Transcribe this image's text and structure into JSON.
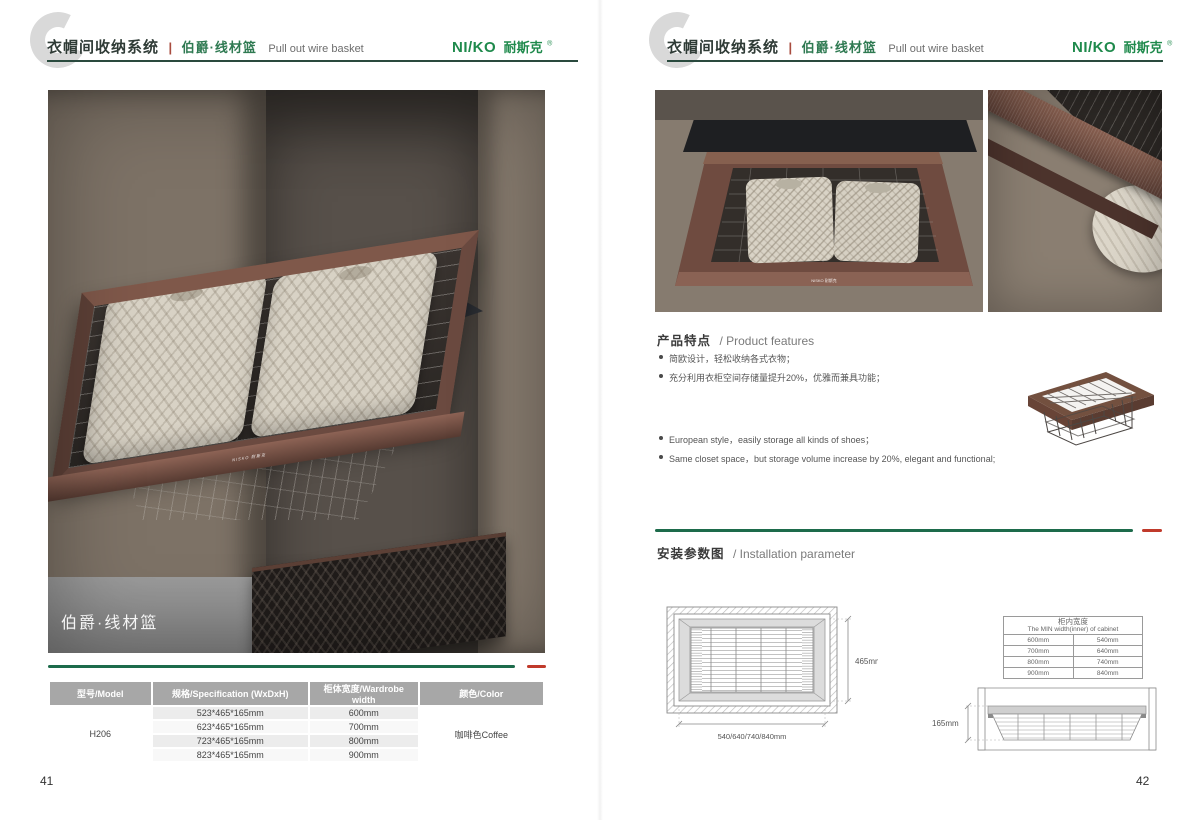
{
  "brand": {
    "logo_latin": "NI/KO",
    "logo_cjk": "耐斯克",
    "logo_reg": "®",
    "logo_full": "NISKO 耐斯克"
  },
  "header": {
    "title_zh": "衣帽间收纳系统",
    "divider": "|",
    "subtitle_zh": "伯爵·线材篮",
    "subtitle_en": "Pull out wire basket"
  },
  "page_left": {
    "photo_label": "伯爵·线材篮",
    "table": {
      "headers": [
        "型号/Model",
        "规格/Specification (WxDxH)",
        "柜体宽度/Wardrobe width",
        "颜色/Color"
      ],
      "model": "H206",
      "rows": [
        {
          "spec": "523*465*165mm",
          "width": "600mm"
        },
        {
          "spec": "623*465*165mm",
          "width": "700mm"
        },
        {
          "spec": "723*465*165mm",
          "width": "800mm"
        },
        {
          "spec": "823*465*165mm",
          "width": "900mm"
        }
      ],
      "color": "咖啡色Coffee"
    },
    "page_number": "41"
  },
  "page_right": {
    "features": {
      "heading_zh": "产品特点",
      "heading_en": "/ Product features",
      "bullets_zh": [
        "简欧设计，轻松收纳各式衣物；",
        "充分利用衣柜空间存储量提升20%，优雅而兼具功能；"
      ],
      "bullets_en": [
        "European style，easily storage all kinds of shoes；",
        "Same closet space，but storage volume increase by 20%, elegant and functional;"
      ]
    },
    "installation": {
      "heading_zh": "安装参数图",
      "heading_en": "/ Installation parameter",
      "top_view": {
        "depth_label": "465mm",
        "width_label": "540/640/740/840mm"
      },
      "front_view": {
        "height_label": "165mm"
      },
      "min_width_table": {
        "title_zh": "柜内宽度",
        "title_en": "The MIN width(inner) of cabinet",
        "rows": [
          {
            "wardrobe": "600mm",
            "min": "540mm"
          },
          {
            "wardrobe": "700mm",
            "min": "640mm"
          },
          {
            "wardrobe": "800mm",
            "min": "740mm"
          },
          {
            "wardrobe": "900mm",
            "min": "840mm"
          }
        ]
      }
    },
    "page_number": "42"
  },
  "colors": {
    "accent_green": "#1d6b4b",
    "accent_red": "#c03a2b",
    "logo_green": "#1f8a4c",
    "frame_coffee": "#6b4a40",
    "table_header_bg": "#a7a7a7"
  }
}
